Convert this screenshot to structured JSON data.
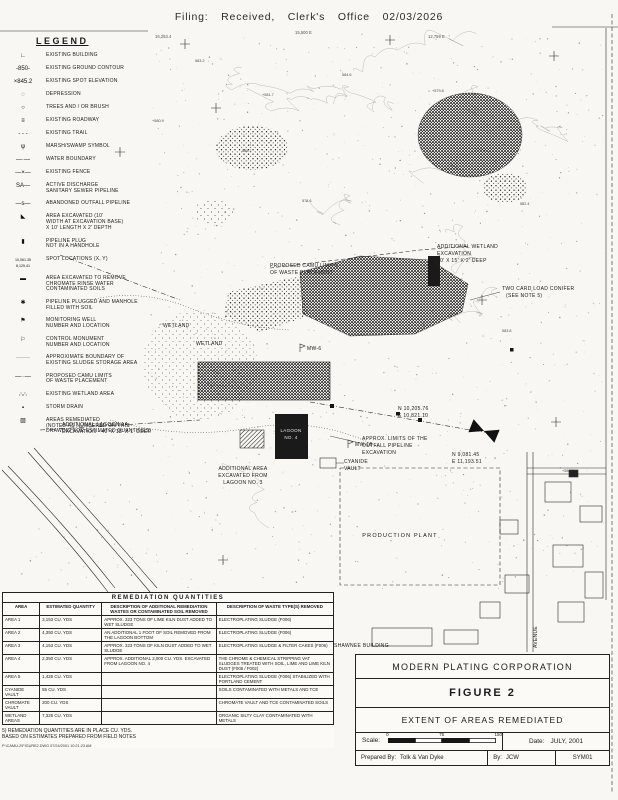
{
  "header": {
    "stamp": "Filing:  Received,  Clerk's Office  02/03/2026"
  },
  "legend": {
    "title": "LEGEND",
    "items": [
      {
        "icon": "building-icon",
        "glyph": "∟",
        "label": "EXISTING BUILDING"
      },
      {
        "icon": "contour-icon",
        "glyph": "-850-",
        "label": "EXISTING GROUND CONTOUR"
      },
      {
        "icon": "spot-elevation-icon",
        "glyph": "×845.2",
        "label": "EXISTING SPOT ELEVATION"
      },
      {
        "icon": "depression-icon",
        "glyph": "◌",
        "label": "DEPRESSION"
      },
      {
        "icon": "trees-icon",
        "glyph": "○",
        "label": "TREES AND / OR BRUSH"
      },
      {
        "icon": "roadway-icon",
        "glyph": "≡",
        "label": "EXISTING ROADWAY"
      },
      {
        "icon": "trail-icon",
        "glyph": "- - -",
        "label": "EXISTING TRAIL"
      },
      {
        "icon": "marsh-icon",
        "glyph": "ψ",
        "label": "MARSH/SWAMP SYMBOL"
      },
      {
        "icon": "water-boundary-icon",
        "glyph": "—·—",
        "label": "WATER BOUNDARY"
      },
      {
        "icon": "fence-icon",
        "glyph": "—×—",
        "label": "EXISTING FENCE"
      },
      {
        "icon": "sewer-icon",
        "glyph": "SA—",
        "label": "ACTIVE DISCHARGE\nSANITARY SEWER PIPELINE"
      },
      {
        "icon": "outfall-icon",
        "glyph": "—s—",
        "label": "ABANDONED OUTFALL PIPELINE"
      },
      {
        "icon": "excavated-arrow-icon",
        "glyph": "◣",
        "label": "AREA EXCAVATED (10'\nWIDTH AT EXCAVATION BASE)\nX 10' LENGTH X 2' DEPTH"
      },
      {
        "icon": "pipeline-plug-icon",
        "glyph": "▮",
        "label": "PIPELINE PLUG\nNOT IN A HANDHOLE"
      },
      {
        "icon": "spot-coordinates-icon",
        "glyph": "10,061.35\n8,125.41",
        "label": "SPOT LOCATIONS (X, Y)"
      },
      {
        "icon": "chromate-area-icon",
        "glyph": "▬",
        "label": "AREA EXCAVATED TO REMOVE\nCHROMATE RINSE WATER\nCONTAMINATED SOILS"
      },
      {
        "icon": "manhole-filled-icon",
        "glyph": "✱",
        "label": "PIPELINE PLUGGED AND MANHOLE\nFILLED WITH SOIL"
      },
      {
        "icon": "monitoring-well-icon",
        "glyph": "⚑",
        "label": "MONITORING WELL\nNUMBER AND LOCATION"
      },
      {
        "icon": "control-monument-icon",
        "glyph": "⚐",
        "label": "CONTROL MONUMENT\nNUMBER AND LOCATION"
      },
      {
        "icon": "sludge-boundary-icon",
        "glyph": "·······",
        "label": "APPROXIMATE BOUNDARY OF\nEXISTING SLUDGE STORAGE AREA"
      },
      {
        "icon": "camu-limits-icon",
        "glyph": "—··—",
        "label": "PROPOSED CAMU LIMITS\nOF WASTE PLACEMENT"
      },
      {
        "icon": "wetland-area-icon",
        "glyph": "∴∴",
        "label": "EXISTING WETLAND AREA"
      },
      {
        "icon": "storm-drain-icon",
        "glyph": "▪",
        "label": "STORM DRAIN"
      },
      {
        "icon": "areas-remediated-icon",
        "glyph": "▨",
        "label": "AREAS REMEDIATED\n(NOTED AS NUMBERED ON THIS\nDRAWING FOR ESTIMATED QUANTITIES)"
      }
    ]
  },
  "map": {
    "grid_1": "16,253.4",
    "grid_2": "15,500 E",
    "grid_3": "12,759 E",
    "wetland1": "WETLAND",
    "wetland2": "WETLAND",
    "camu_limits_1": "PROPOSED CAMU LIMITS",
    "camu_limits_2": "OF WASTE PLACEMENT",
    "wetland_exc_1": "ADDITIONAL WETLAND",
    "wetland_exc_2": "EXCAVATION",
    "wetland_exc_3": "40' X 15' X 2' DEEP",
    "note5_1": "TWO CARD LOAD CONIFER",
    "note5_2": "(SEE NOTE 5)",
    "lagoon1a_1": "ADDITIONAL LAGOON 1A",
    "lagoon1a_2": "EXCAVATION - 40' X 15' X 1' DEEP",
    "lagoon4_1": "LAGOON",
    "lagoon4_2": "NO. 4",
    "lagoon3_1": "ADDITIONAL AREA",
    "lagoon3_2": "EXCAVATED FROM",
    "lagoon3_3": "LAGOON NO. 3",
    "outfall_1": "APPROX. LIMITS OF THE",
    "outfall_2": "OUTFALL PIPELINE",
    "outfall_3": "EXCAVATION",
    "cyanide_1": "CYANIDE",
    "cyanide_2": "VAULT",
    "coord_a1": "N 10,205.76",
    "coord_a2": "E 10,821.10",
    "coord_b1": "N 9,081.45",
    "coord_b2": "E 11,193.51",
    "mw16": "MW-16",
    "mw6": "MW-6",
    "production_plant": "PRODUCTION PLANT",
    "shawnee": "SHAWNEE BUILDING",
    "avenue": "AVENUE",
    "spot_elevations": [
      "583.2",
      "+581.7",
      "584.6",
      "+579.8",
      "582.4",
      "585.1",
      "+580.9",
      "578.6",
      "583.8",
      "+586.2"
    ]
  },
  "table": {
    "title": "REMEDIATION QUANTITIES",
    "headers": [
      "AREA",
      "ESTIMATED QUANTITY",
      "DESCRIPTION OF ADDITIONAL REMEDIATION WASTES OR CONTAMINATED SOIL REMOVED",
      "DESCRIPTION OF WASTE TYPE(S) REMOVED"
    ],
    "rows": [
      {
        "area": "AREA 1",
        "quantity": "3,153 CU. YDS",
        "description": "APPROX. 323 TONS OF LIME KILN DUST ADDED TO WET SLUDGE",
        "waste_type": "ELECTROPLATING SLUDGE (F006)"
      },
      {
        "area": "AREA 2",
        "quantity": "4,350 CU. YDS",
        "description": "AN ADDITIONAL 1 FOOT OF SOIL REMOVED FROM THE LAGOON BOTTOM",
        "waste_type": "ELECTROPLATING SLUDGE (F006)"
      },
      {
        "area": "AREA 3",
        "quantity": "4,153 CU. YDS",
        "description": "APPROX. 323 TONS OF KILN DUST ADDED TO WET SLUDGE",
        "waste_type": "ELECTROPLATING SLUDGE & FILTER CAKES (F006)"
      },
      {
        "area": "AREA 4",
        "quantity": "2,350 CU. YDS",
        "description": "APPROX. ADDITIONAL 2,000 CU. YDS. EXCAVATED FROM LAGOON NO. 4",
        "waste_type": "THE CHROME & CHEMICAL STRIPPING VAT SLUDGES TREATED WITH SOIL, LIME AND LIME KILN DUST (F006 / F002)"
      },
      {
        "area": "AREA 5",
        "quantity": "1,426 CU. YDS",
        "description": "",
        "waste_type": "ELECTROPLATING SLUDGE (F006) STABILIZED WITH PORTLAND CEMENT"
      },
      {
        "area": "CYANIDE VAULT",
        "quantity": "55 CU. YDS",
        "description": "",
        "waste_type": "SOILS CONTAMINATED WITH METALS AND TCE"
      },
      {
        "area": "CHROMATE VAULT",
        "quantity": "200 CU. YDS",
        "description": "",
        "waste_type": "CHROMATE VAULT AND TCE CONTAMINATED SOILS"
      },
      {
        "area": "WETLAND AREAS",
        "quantity": "7,325 CU. YDS",
        "description": "",
        "waste_type": "ORGANIC SILTY CLAY CONTAMINATED WITH METALS"
      }
    ],
    "note": "5) REMEDIATION QUANTITIES ARE IN PLACE CU. YDS.\nBASED ON ESTIMATES PREPARED FROM FIELD NOTES",
    "cad_footer": "P:\\CAMU-2\\FIGURE2.DWG  07/24/2001 10:21:23 AM"
  },
  "titleblock": {
    "company": "MODERN PLATING CORPORATION",
    "figure": "FIGURE 2",
    "subtitle": "EXTENT OF AREAS REMEDIATED",
    "scale_label": "Scale:",
    "scale_ticks": [
      "0",
      "75",
      "150"
    ],
    "date_label": "Date:",
    "date": "JULY, 2001",
    "prepared_label": "Prepared By:",
    "prepared": "Tolk & Van Dyke",
    "by_label": "By:",
    "by": "JCW",
    "drawing_no": "SYM01"
  }
}
